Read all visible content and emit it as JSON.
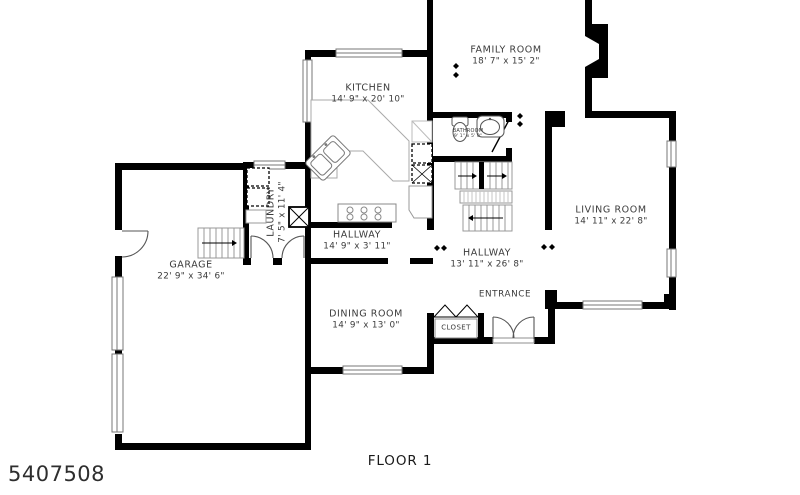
{
  "plan": {
    "floor_label": "FLOOR 1",
    "listing_number": "5407508"
  },
  "rooms": [
    {
      "id": "family-room",
      "name": "FAMILY ROOM",
      "dims": "18' 7\" x 15' 2\""
    },
    {
      "id": "kitchen",
      "name": "KITCHEN",
      "dims": "14' 9\" x 20' 10\""
    },
    {
      "id": "bathroom",
      "name": "BATHROOM",
      "dims": "9' 1\" x 5' 0\""
    },
    {
      "id": "living-room",
      "name": "LIVING ROOM",
      "dims": "14' 11\" x 22' 8\""
    },
    {
      "id": "laundry",
      "name": "LAUNDRY",
      "dims": "7' 5\" x 11' 4\""
    },
    {
      "id": "hallway-upper",
      "name": "HALLWAY",
      "dims": "14' 9\" x 3' 11\""
    },
    {
      "id": "hallway-main",
      "name": "HALLWAY",
      "dims": "13' 11\" x 26' 8\""
    },
    {
      "id": "garage",
      "name": "GARAGE",
      "dims": "22' 9\" x 34' 6\""
    },
    {
      "id": "dining-room",
      "name": "DINING ROOM",
      "dims": "14' 9\" x 13' 0\""
    },
    {
      "id": "entrance",
      "name": "ENTRANCE",
      "dims": ""
    },
    {
      "id": "closet",
      "name": "CLOSET",
      "dims": ""
    }
  ],
  "colors": {
    "wall": "#000000",
    "label_text": "#3b3b3b",
    "fixture_line": "#999999",
    "window_line": "#777777",
    "background": "#ffffff"
  }
}
